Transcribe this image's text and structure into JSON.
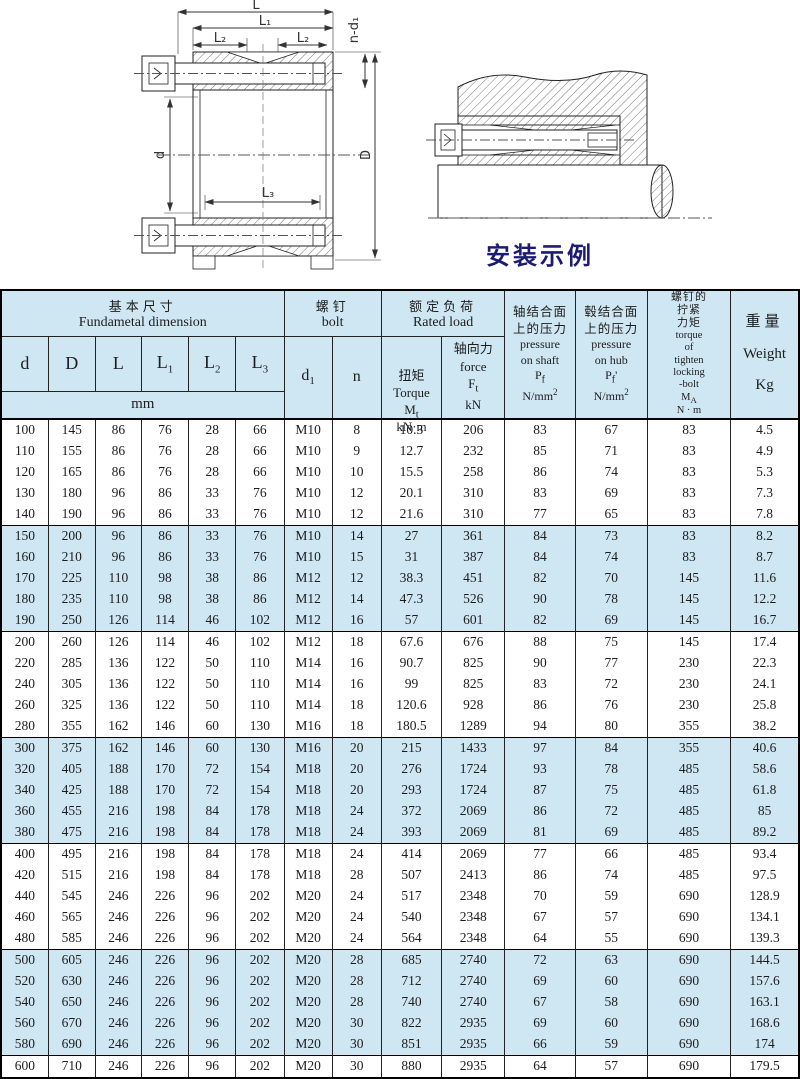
{
  "colors": {
    "light_blue": "#cfe7f3",
    "border": "#222222",
    "caption": "#1b1b74",
    "text": "#1d1d1d"
  },
  "drawing": {
    "dim_L": "L",
    "dim_L1": "L₁",
    "dim_L2": "L₂",
    "dim_L3": "L₃",
    "dim_d": "d",
    "dim_D": "D",
    "dim_nd1": "n-d₁",
    "caption": "安装示例"
  },
  "table": {
    "header": {
      "fundamental_zh": "基本尺寸",
      "fundamental_en": "Fundametal  dimension",
      "bolt_zh": "螺钉",
      "bolt_en": "bolt",
      "rated_zh": "额定负荷",
      "rated_en": "Rated load",
      "col_d": "d",
      "col_D": "D",
      "col_L": "L",
      "col_L1_base": "L",
      "col_L1_sub": "1",
      "col_L2_base": "L",
      "col_L2_sub": "2",
      "col_L3_base": "L",
      "col_L3_sub": "3",
      "col_d1_base": "d",
      "col_d1_sub": "1",
      "col_n": "n",
      "mm": "mm",
      "torque_zh": "扭矩",
      "torque_en": "Torque",
      "torque_sym": "M",
      "torque_sub": "t",
      "torque_unit": "kN·m",
      "force_zh": "轴向力",
      "force_en": "force",
      "force_sym": "F",
      "force_sub": "t",
      "force_unit": "kN",
      "pshaft_zh1": "轴结合面",
      "pshaft_zh2": "上的压力",
      "pshaft_en1": "pressure",
      "pshaft_en2": "on shaft",
      "pshaft_sym": "P",
      "pshaft_sub": "f",
      "pshaft_unit": "N/mm",
      "pshaft_unit_sup": "2",
      "phub_zh1": "毂结合面",
      "phub_zh2": "上的压力",
      "phub_en1": "pressure",
      "phub_en2": "on hub",
      "phub_sym": "P",
      "phub_sub": "f",
      "phub_prime": "'",
      "phub_unit": "N/mm",
      "phub_unit_sup": "2",
      "tight_zh1": "螺钉的",
      "tight_zh2": "拧紧",
      "tight_zh3": "力矩",
      "tight_en1": "torque",
      "tight_en2": "of",
      "tight_en3": "tighten",
      "tight_en4": "locking",
      "tight_en5": "-bolt",
      "tight_sym": "M",
      "tight_sub": "A",
      "tight_unit": "N · m",
      "weight_zh": "重量",
      "weight_en": "Weight",
      "weight_unit": "Kg"
    },
    "rows": [
      [
        "100",
        "145",
        "86",
        "76",
        "28",
        "66",
        "M10",
        "8",
        "10.3",
        "206",
        "83",
        "67",
        "83",
        "4.5"
      ],
      [
        "110",
        "155",
        "86",
        "76",
        "28",
        "66",
        "M10",
        "9",
        "12.7",
        "232",
        "85",
        "71",
        "83",
        "4.9"
      ],
      [
        "120",
        "165",
        "86",
        "76",
        "28",
        "66",
        "M10",
        "10",
        "15.5",
        "258",
        "86",
        "74",
        "83",
        "5.3"
      ],
      [
        "130",
        "180",
        "96",
        "86",
        "33",
        "76",
        "M10",
        "12",
        "20.1",
        "310",
        "83",
        "69",
        "83",
        "7.3"
      ],
      [
        "140",
        "190",
        "96",
        "86",
        "33",
        "76",
        "M10",
        "12",
        "21.6",
        "310",
        "77",
        "65",
        "83",
        "7.8"
      ],
      [
        "150",
        "200",
        "96",
        "86",
        "33",
        "76",
        "M10",
        "14",
        "27",
        "361",
        "84",
        "73",
        "83",
        "8.2"
      ],
      [
        "160",
        "210",
        "96",
        "86",
        "33",
        "76",
        "M10",
        "15",
        "31",
        "387",
        "84",
        "74",
        "83",
        "8.7"
      ],
      [
        "170",
        "225",
        "110",
        "98",
        "38",
        "86",
        "M12",
        "12",
        "38.3",
        "451",
        "82",
        "70",
        "145",
        "11.6"
      ],
      [
        "180",
        "235",
        "110",
        "98",
        "38",
        "86",
        "M12",
        "14",
        "47.3",
        "526",
        "90",
        "78",
        "145",
        "12.2"
      ],
      [
        "190",
        "250",
        "126",
        "114",
        "46",
        "102",
        "M12",
        "16",
        "57",
        "601",
        "82",
        "69",
        "145",
        "16.7"
      ],
      [
        "200",
        "260",
        "126",
        "114",
        "46",
        "102",
        "M12",
        "18",
        "67.6",
        "676",
        "88",
        "75",
        "145",
        "17.4"
      ],
      [
        "220",
        "285",
        "136",
        "122",
        "50",
        "110",
        "M14",
        "16",
        "90.7",
        "825",
        "90",
        "77",
        "230",
        "22.3"
      ],
      [
        "240",
        "305",
        "136",
        "122",
        "50",
        "110",
        "M14",
        "16",
        "99",
        "825",
        "83",
        "72",
        "230",
        "24.1"
      ],
      [
        "260",
        "325",
        "136",
        "122",
        "50",
        "110",
        "M14",
        "18",
        "120.6",
        "928",
        "86",
        "76",
        "230",
        "25.8"
      ],
      [
        "280",
        "355",
        "162",
        "146",
        "60",
        "130",
        "M16",
        "18",
        "180.5",
        "1289",
        "94",
        "80",
        "355",
        "38.2"
      ],
      [
        "300",
        "375",
        "162",
        "146",
        "60",
        "130",
        "M16",
        "20",
        "215",
        "1433",
        "97",
        "84",
        "355",
        "40.6"
      ],
      [
        "320",
        "405",
        "188",
        "170",
        "72",
        "154",
        "M18",
        "20",
        "276",
        "1724",
        "93",
        "78",
        "485",
        "58.6"
      ],
      [
        "340",
        "425",
        "188",
        "170",
        "72",
        "154",
        "M18",
        "20",
        "293",
        "1724",
        "87",
        "75",
        "485",
        "61.8"
      ],
      [
        "360",
        "455",
        "216",
        "198",
        "84",
        "178",
        "M18",
        "24",
        "372",
        "2069",
        "86",
        "72",
        "485",
        "85"
      ],
      [
        "380",
        "475",
        "216",
        "198",
        "84",
        "178",
        "M18",
        "24",
        "393",
        "2069",
        "81",
        "69",
        "485",
        "89.2"
      ],
      [
        "400",
        "495",
        "216",
        "198",
        "84",
        "178",
        "M18",
        "24",
        "414",
        "2069",
        "77",
        "66",
        "485",
        "93.4"
      ],
      [
        "420",
        "515",
        "216",
        "198",
        "84",
        "178",
        "M18",
        "28",
        "507",
        "2413",
        "86",
        "74",
        "485",
        "97.5"
      ],
      [
        "440",
        "545",
        "246",
        "226",
        "96",
        "202",
        "M20",
        "24",
        "517",
        "2348",
        "70",
        "59",
        "690",
        "128.9"
      ],
      [
        "460",
        "565",
        "246",
        "226",
        "96",
        "202",
        "M20",
        "24",
        "540",
        "2348",
        "67",
        "57",
        "690",
        "134.1"
      ],
      [
        "480",
        "585",
        "246",
        "226",
        "96",
        "202",
        "M20",
        "24",
        "564",
        "2348",
        "64",
        "55",
        "690",
        "139.3"
      ],
      [
        "500",
        "605",
        "246",
        "226",
        "96",
        "202",
        "M20",
        "28",
        "685",
        "2740",
        "72",
        "63",
        "690",
        "144.5"
      ],
      [
        "520",
        "630",
        "246",
        "226",
        "96",
        "202",
        "M20",
        "28",
        "712",
        "2740",
        "69",
        "60",
        "690",
        "157.6"
      ],
      [
        "540",
        "650",
        "246",
        "226",
        "96",
        "202",
        "M20",
        "28",
        "740",
        "2740",
        "67",
        "58",
        "690",
        "163.1"
      ],
      [
        "560",
        "670",
        "246",
        "226",
        "96",
        "202",
        "M20",
        "30",
        "822",
        "2935",
        "69",
        "60",
        "690",
        "168.6"
      ],
      [
        "580",
        "690",
        "246",
        "226",
        "96",
        "202",
        "M20",
        "30",
        "851",
        "2935",
        "66",
        "59",
        "690",
        "174"
      ],
      [
        "600",
        "710",
        "246",
        "226",
        "96",
        "202",
        "M20",
        "30",
        "880",
        "2935",
        "64",
        "57",
        "690",
        "179.5"
      ]
    ]
  }
}
